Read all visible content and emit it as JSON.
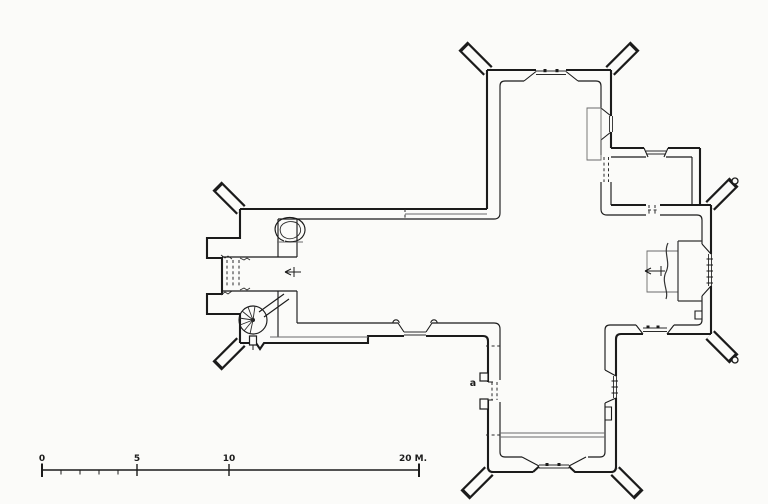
{
  "page": {
    "background": "#fbfbf9"
  },
  "drawing": {
    "ink": "#1b1b1b",
    "thin_ink": "#6a6a6a",
    "subject": "cruciform church ground plan with west tower, nave, transept arms, chancel with altar, sacristy and spiral staircase",
    "labels": {
      "scale_0": "0",
      "scale_5": "5",
      "scale_10": "10",
      "scale_20": "20 M.",
      "door": "a"
    }
  }
}
